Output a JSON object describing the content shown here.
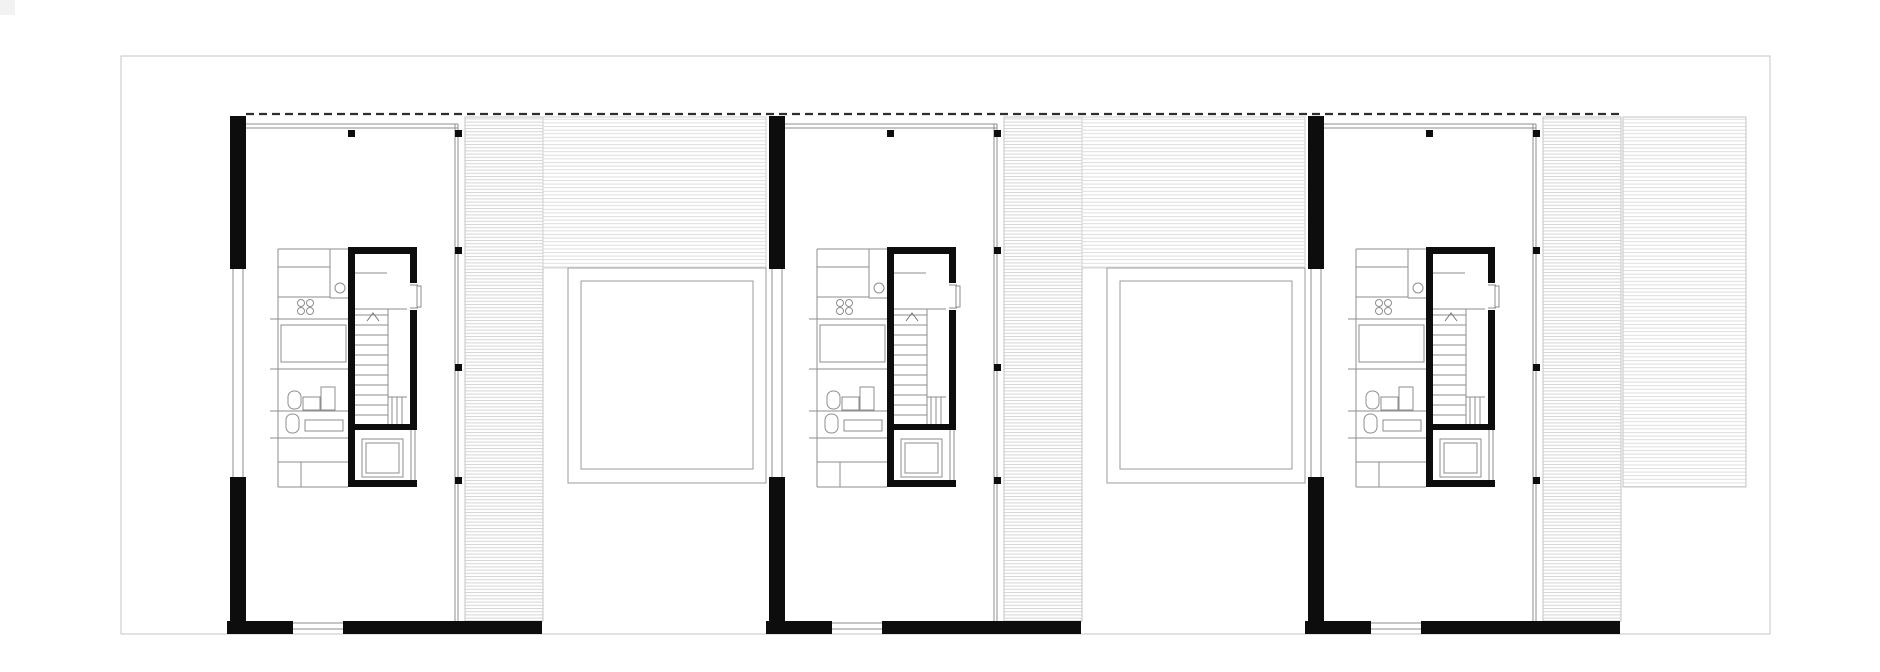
{
  "document": {
    "type": "architectural-floor-plan",
    "visible_text": [],
    "units_count": 3
  },
  "canvas": {
    "w": 1880,
    "h": 672,
    "bg": "#ffffff"
  },
  "corner_artifact": {
    "x": 0,
    "y": 0,
    "w": 15,
    "h": 15,
    "color": "#f2f2f2"
  },
  "sheet": {
    "x": 121,
    "y": 56,
    "w": 1649,
    "h": 578,
    "stroke": "#c6c6c6",
    "stroke_w": 1.4
  },
  "palette": {
    "wall": "#0d0d0d",
    "thin": "#8e8e8e",
    "thin_light": "#b5b5b5",
    "hatch_strip": "#d5d5d5",
    "hatch_band": "#dedede",
    "hatch_edge": "#c4c4c4",
    "courtyard": "#9b9b9b",
    "dash": "#2e2e2e"
  },
  "roof_dash_line": {
    "x1": 246,
    "x2": 1621,
    "y": 114,
    "width": 2.2,
    "dasharray": "8 5"
  },
  "units": {
    "base_x": 230,
    "offsets": [
      0,
      539,
      1078
    ],
    "black_rects": [
      [
        0,
        116,
        16,
        153
      ],
      [
        0,
        477,
        16,
        157
      ],
      [
        -3,
        621,
        66,
        13
      ],
      [
        113,
        621,
        199,
        13
      ],
      [
        118,
        247,
        69,
        7
      ],
      [
        118,
        247,
        7,
        240
      ],
      [
        180,
        252,
        7,
        31
      ],
      [
        180,
        310,
        7,
        120
      ],
      [
        125,
        424,
        62,
        6
      ],
      [
        118,
        480,
        69,
        7
      ]
    ],
    "columns": {
      "size": 7,
      "positions": [
        [
          118,
          130
        ],
        [
          225,
          130
        ],
        [
          225,
          247
        ],
        [
          225,
          364
        ],
        [
          225,
          477
        ]
      ]
    },
    "thin_lines": [
      [
        16,
        124,
        228,
        124
      ],
      [
        16,
        128,
        228,
        128
      ],
      [
        225,
        124,
        225,
        621
      ],
      [
        228,
        124,
        228,
        621
      ],
      [
        3,
        269,
        3,
        477
      ],
      [
        13,
        269,
        13,
        477
      ],
      [
        63,
        623,
        113,
        623
      ],
      [
        63,
        629,
        113,
        629
      ],
      [
        48,
        249,
        48,
        487
      ],
      [
        48,
        249,
        118,
        249
      ],
      [
        48,
        267,
        100,
        267
      ],
      [
        100,
        249,
        100,
        298
      ],
      [
        100,
        298,
        118,
        298
      ],
      [
        48,
        297,
        100,
        297
      ],
      [
        48,
        319,
        118,
        319
      ],
      [
        40,
        319,
        48,
        319
      ],
      [
        48,
        369,
        118,
        369
      ],
      [
        40,
        369,
        48,
        369
      ],
      [
        48,
        411,
        118,
        411
      ],
      [
        40,
        411,
        48,
        411
      ],
      [
        48,
        438,
        118,
        438
      ],
      [
        40,
        438,
        48,
        438
      ],
      [
        48,
        462,
        118,
        462
      ],
      [
        71,
        462,
        71,
        487
      ],
      [
        48,
        487,
        118,
        487
      ],
      [
        123,
        273,
        157,
        273
      ],
      [
        123,
        309,
        177,
        309
      ],
      [
        158,
        309,
        158,
        425
      ],
      [
        158,
        397,
        177,
        397
      ],
      [
        162,
        397,
        162,
        425
      ],
      [
        167,
        397,
        167,
        425
      ],
      [
        172,
        397,
        172,
        425
      ],
      [
        180,
        285,
        188,
        285
      ],
      [
        180,
        308,
        188,
        308
      ],
      [
        181,
        430,
        181,
        480
      ],
      [
        185,
        430,
        185,
        480
      ]
    ],
    "thin_rects": [
      [
        51,
        325,
        65,
        37
      ],
      [
        132,
        439,
        41,
        38
      ],
      [
        136,
        443,
        33,
        30
      ],
      [
        75,
        420,
        38,
        11
      ],
      [
        73,
        397,
        17,
        13
      ],
      [
        91,
        387,
        14,
        23
      ],
      [
        187,
        286,
        4,
        21
      ]
    ],
    "capsules": [
      [
        58,
        391,
        13,
        18
      ],
      [
        56,
        414,
        13,
        19
      ]
    ],
    "circles": [
      [
        110,
        288,
        5
      ],
      [
        71,
        303,
        3.5
      ],
      [
        80,
        303,
        3.5
      ],
      [
        71,
        311,
        3.5
      ],
      [
        80,
        311,
        3.5
      ]
    ],
    "stair": {
      "tread_x1": 125,
      "tread_x2": 158,
      "tread_y0": 315,
      "tread_step": 10,
      "tread_count": 11,
      "chevron": "137,321 143,313 149,321"
    },
    "deck_strip": [
      235,
      117,
      78,
      504
    ],
    "band": [
      313,
      117,
      223,
      151
    ],
    "band_units": [
      0,
      1
    ],
    "courtyard_outer": [
      338,
      268,
      198,
      215
    ],
    "courtyard_inner": [
      351,
      281,
      172,
      188
    ]
  },
  "extension": {
    "rect": [
      1623,
      117,
      123,
      370
    ]
  }
}
